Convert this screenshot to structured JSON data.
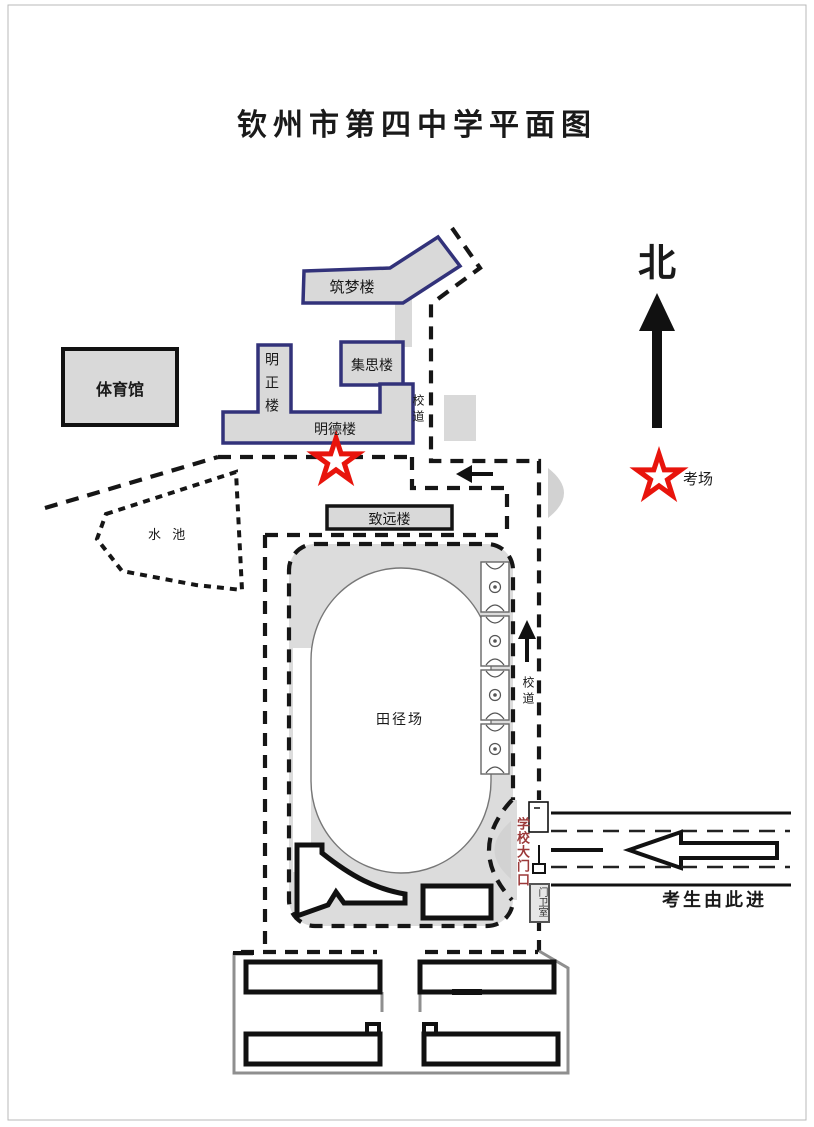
{
  "page": {
    "title": "钦州市第四中学平面图"
  },
  "compass": {
    "north": "北"
  },
  "legend": {
    "exam_site": "考场"
  },
  "buildings": {
    "gym": "体育馆",
    "zhumeng": "筑梦楼",
    "mingzheng": "明正楼",
    "jisi": "集思楼",
    "mingde": "明德楼",
    "zhiyuan": "致远楼",
    "guard_room": "门卫室"
  },
  "places": {
    "pond": "水 池",
    "track_field": "田径场",
    "school_road_upper": "校道",
    "school_road_lower": "校道",
    "school_gate": "学校大门口"
  },
  "notes": {
    "entry": "考生由此进"
  },
  "colors": {
    "building_border_navy": "#32327a",
    "star_red": "#e8140c",
    "fill_gray": "#d9d9d9",
    "gate_text_red": "#9c3a3a"
  }
}
